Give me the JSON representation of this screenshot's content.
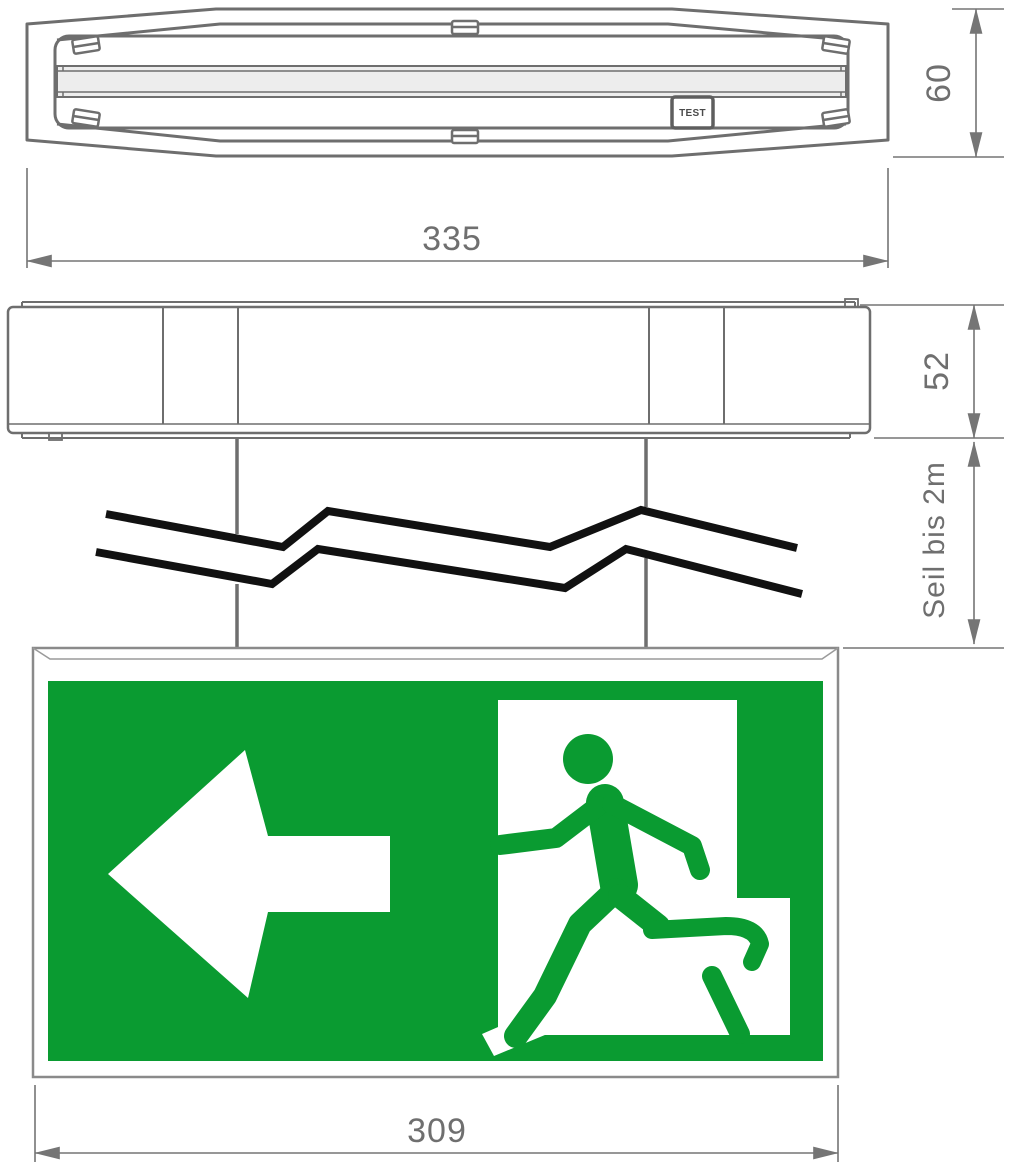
{
  "views": {
    "top_view": {
      "width_dim": "335",
      "height_dim": "60",
      "test_button_label": "TEST"
    },
    "side_view": {
      "height_dim": "52"
    },
    "suspension": {
      "cable_dim_label": "Seil bis 2m"
    },
    "exit_sign": {
      "width_dim": "309"
    }
  },
  "colors": {
    "sign_green": "#0a9b31",
    "line_gray": "#6e6e6e",
    "dim_gray": "#757575",
    "break_black": "#111111",
    "lamp_fill": "#ededed",
    "panel_white": "#ffffff"
  }
}
